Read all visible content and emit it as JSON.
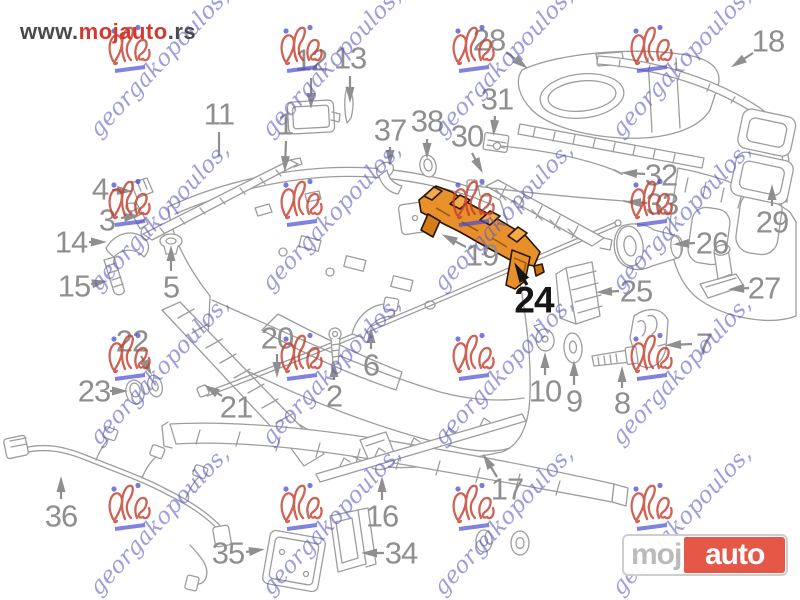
{
  "header": {
    "url_prefix": "www.",
    "url_brand": "mojauto",
    "url_suffix": ".rs"
  },
  "logo": {
    "part_gray": "moj",
    "part_red": "auto",
    "red_color": "#e4513f",
    "gray_color": "#b9b9b9"
  },
  "watermark": {
    "text": "georgakopoulos,",
    "text_color": "#5858c6",
    "stamp_red": "#c5402f",
    "stamp_blue": "#4b4bcf",
    "grid_cols": [
      128,
      300,
      472,
      650
    ],
    "grid_rows": [
      50,
      204,
      358,
      508
    ]
  },
  "diagram": {
    "type": "exploded-parts-diagram",
    "subject": "rear bumper assembly",
    "line_color": "#9d9d9d",
    "label_color": "#8f8f8f",
    "highlight_color": "#e8912c",
    "highlighted_part": "24"
  },
  "callouts": [
    {
      "n": "1",
      "x": 285,
      "y": 124,
      "line": [
        286,
        141,
        285,
        166
      ],
      "head": true
    },
    {
      "n": "2",
      "x": 334,
      "y": 396,
      "line": [
        334,
        380,
        334,
        367
      ],
      "head": true
    },
    {
      "n": "3",
      "x": 107,
      "y": 220,
      "line": [
        121,
        218,
        134,
        216
      ],
      "head": true
    },
    {
      "n": "4",
      "x": 100,
      "y": 189,
      "line": [
        112,
        190,
        127,
        191
      ],
      "head": true
    },
    {
      "n": "5",
      "x": 171,
      "y": 287,
      "line": [
        171,
        271,
        171,
        251
      ],
      "head": true
    },
    {
      "n": "6",
      "x": 371,
      "y": 365,
      "line": [
        371,
        349,
        371,
        333
      ],
      "head": true
    },
    {
      "n": "7",
      "x": 704,
      "y": 344,
      "line": [
        692,
        344,
        671,
        345
      ],
      "head": true
    },
    {
      "n": "8",
      "x": 622,
      "y": 403,
      "line": [
        622,
        388,
        622,
        372
      ],
      "head": true
    },
    {
      "n": "9",
      "x": 574,
      "y": 401,
      "line": [
        574,
        385,
        574,
        366
      ],
      "head": true
    },
    {
      "n": "10",
      "x": 545,
      "y": 391,
      "line": [
        545,
        375,
        545,
        358
      ],
      "head": true
    },
    {
      "n": "11",
      "x": 219,
      "y": 114,
      "line": [
        219,
        132,
        219,
        156
      ],
      "head": false
    },
    {
      "n": "12",
      "x": 311,
      "y": 60,
      "line": [
        311,
        78,
        311,
        103
      ],
      "head": true
    },
    {
      "n": "13",
      "x": 350,
      "y": 58,
      "line": [
        350,
        76,
        350,
        97
      ],
      "head": true
    },
    {
      "n": "14",
      "x": 71,
      "y": 242,
      "line": [
        89,
        242,
        101,
        242
      ],
      "head": true
    },
    {
      "n": "15",
      "x": 74,
      "y": 286,
      "line": [
        91,
        284,
        102,
        282
      ],
      "head": true
    },
    {
      "n": "16",
      "x": 382,
      "y": 516,
      "line": [
        382,
        500,
        382,
        482
      ],
      "head": true
    },
    {
      "n": "17",
      "x": 507,
      "y": 489,
      "line": [
        497,
        477,
        486,
        459
      ],
      "head": true
    },
    {
      "n": "18",
      "x": 768,
      "y": 41,
      "line": [
        753,
        53,
        736,
        64
      ],
      "head": true
    },
    {
      "n": "19",
      "x": 482,
      "y": 255,
      "line": [
        466,
        247,
        447,
        237
      ],
      "head": true
    },
    {
      "n": "20",
      "x": 277,
      "y": 338,
      "line": [
        277,
        354,
        277,
        372
      ],
      "head": true
    },
    {
      "n": "21",
      "x": 236,
      "y": 407,
      "line": [
        222,
        396,
        209,
        388
      ],
      "head": true
    },
    {
      "n": "22",
      "x": 132,
      "y": 341,
      "line": [
        141,
        356,
        149,
        370
      ],
      "head": true
    },
    {
      "n": "23",
      "x": 94,
      "y": 391,
      "line": [
        110,
        391,
        122,
        391
      ],
      "head": true
    },
    {
      "n": "24",
      "x": 534,
      "y": 300,
      "line": [
        527,
        285,
        518,
        269
      ],
      "head": true,
      "style": "highlight"
    },
    {
      "n": "25",
      "x": 636,
      "y": 291,
      "line": [
        619,
        291,
        602,
        292
      ],
      "head": true
    },
    {
      "n": "26",
      "x": 712,
      "y": 243,
      "line": [
        695,
        243,
        679,
        244
      ],
      "head": true
    },
    {
      "n": "27",
      "x": 764,
      "y": 288,
      "line": [
        749,
        288,
        734,
        289
      ],
      "head": true
    },
    {
      "n": "28",
      "x": 489,
      "y": 40,
      "line": [
        506,
        52,
        523,
        65
      ],
      "head": true
    },
    {
      "n": "29",
      "x": 772,
      "y": 222,
      "line": [
        772,
        206,
        772,
        190
      ],
      "head": true
    },
    {
      "n": "30",
      "x": 467,
      "y": 136,
      "line": [
        472,
        153,
        480,
        168
      ],
      "head": true
    },
    {
      "n": "31",
      "x": 497,
      "y": 99,
      "line": [
        495,
        116,
        494,
        130
      ],
      "head": true
    },
    {
      "n": "32",
      "x": 661,
      "y": 175,
      "line": [
        645,
        174,
        627,
        173
      ],
      "head": true
    },
    {
      "n": "33",
      "x": 662,
      "y": 204,
      "line": [
        647,
        203,
        631,
        202
      ],
      "head": true
    },
    {
      "n": "34",
      "x": 401,
      "y": 553,
      "line": [
        384,
        553,
        367,
        553
      ],
      "head": true
    },
    {
      "n": "35",
      "x": 228,
      "y": 553,
      "line": [
        246,
        552,
        259,
        550
      ],
      "head": true
    },
    {
      "n": "36",
      "x": 61,
      "y": 516,
      "line": [
        61,
        499,
        61,
        482
      ],
      "head": true
    },
    {
      "n": "37",
      "x": 390,
      "y": 130,
      "line": [
        390,
        147,
        390,
        160
      ],
      "head": true
    },
    {
      "n": "38",
      "x": 427,
      "y": 121,
      "line": [
        427,
        139,
        427,
        153
      ],
      "head": true
    }
  ]
}
